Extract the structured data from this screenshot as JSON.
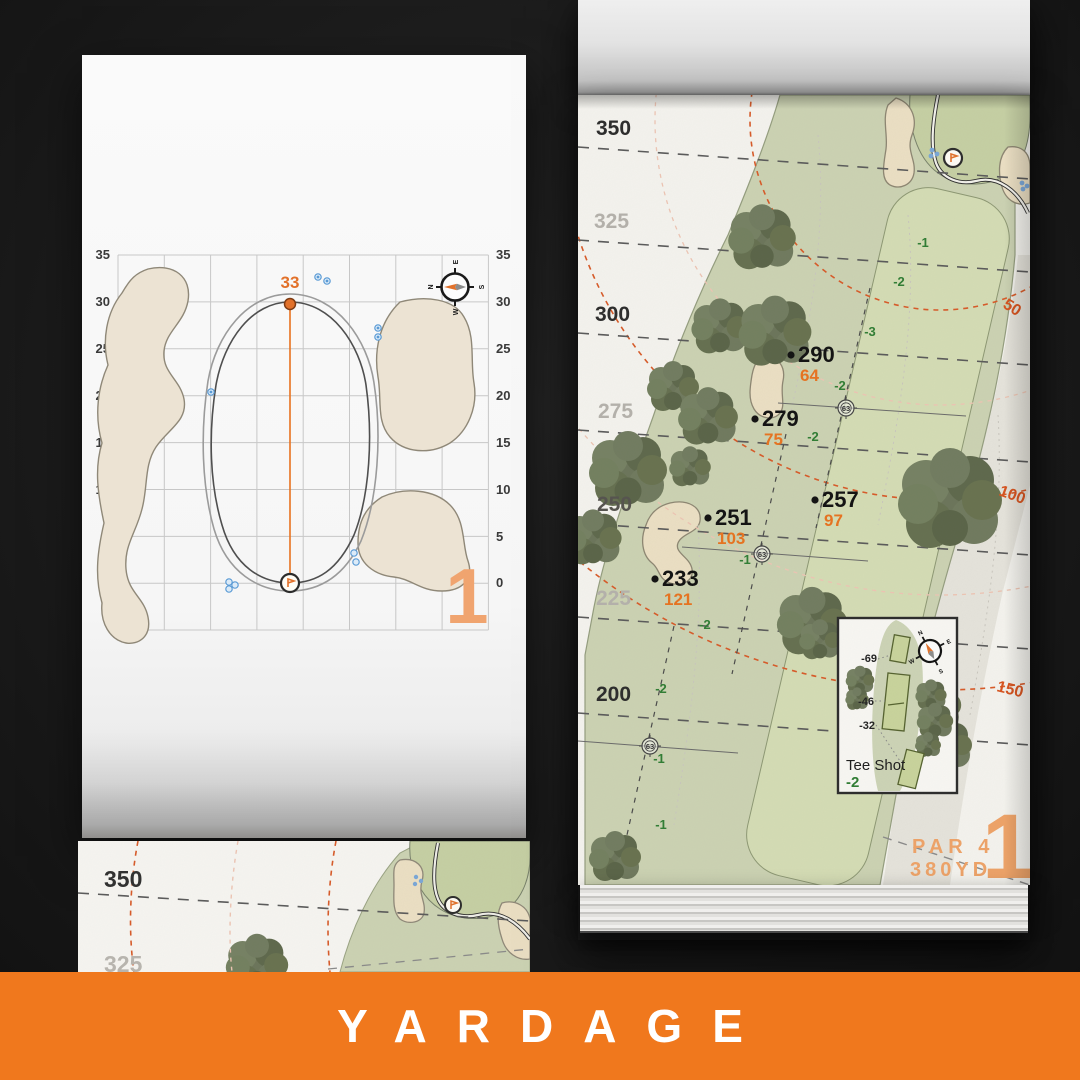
{
  "banner": {
    "label": "YARDAGE"
  },
  "colors": {
    "banner_orange": "#f0781d",
    "accent_orange": "#e8721f",
    "muted_orange": "#efa368",
    "arc_orange": "#d85a28",
    "sand": "#ece0c4",
    "fairway_green": "#ccd3b3",
    "tree_green": "#6b755a",
    "elevation_green": "#2f7d33"
  },
  "left_page": {
    "pin_distance": "33",
    "hole_number": "1",
    "axis_labels": [
      "35",
      "30",
      "25",
      "20",
      "15",
      "10",
      "5",
      "0"
    ],
    "compass": {
      "n": "N",
      "e": "E",
      "s": "S",
      "w": "W"
    }
  },
  "right_page": {
    "hole_number": "1",
    "par_label": "PAR 4",
    "yardage_label": "380YD",
    "distance_labels": [
      "350",
      "325",
      "300",
      "275",
      "250",
      "225",
      "200"
    ],
    "arc_labels": [
      "50",
      "100",
      "150"
    ],
    "callouts": [
      {
        "yards": "290",
        "carry": "64"
      },
      {
        "yards": "279",
        "carry": "75"
      },
      {
        "yards": "257",
        "carry": "97"
      },
      {
        "yards": "251",
        "carry": "103"
      },
      {
        "yards": "233",
        "carry": "121"
      }
    ],
    "elevations": [
      "-1",
      "-2",
      "-3",
      "-2",
      "-2",
      "-1",
      "-2",
      "-2",
      "-1",
      "-1"
    ],
    "sprinklers": [
      "63",
      "63",
      "63"
    ],
    "tee_inset": {
      "title": "Tee Shot",
      "elevation": "-2",
      "markers": [
        "-69",
        "-46",
        "-32"
      ],
      "compass": {
        "n": "N",
        "e": "E",
        "s": "S",
        "w": "W"
      }
    }
  },
  "preview_page": {
    "distance_labels": [
      "350",
      "325"
    ]
  }
}
